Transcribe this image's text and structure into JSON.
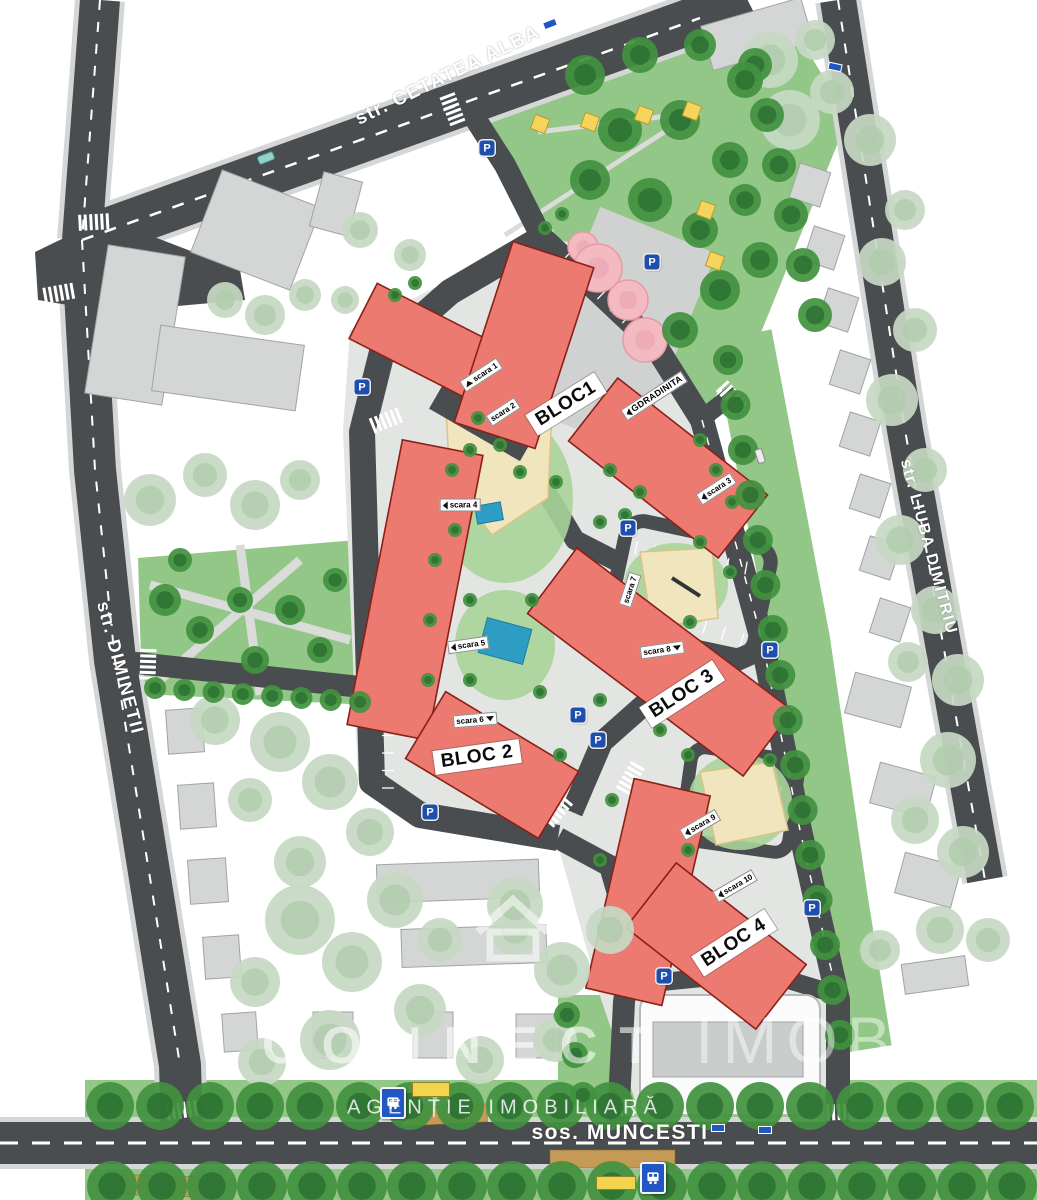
{
  "streets": {
    "top": "str. CETATEA ALBA",
    "left": "str. DIMINETII",
    "right": "str. LIUBA DIMITRIU",
    "bottom": "sos. MUNCESTI"
  },
  "buildings": {
    "bloc1": "BLOC1",
    "bloc2": "BLOC 2",
    "bloc3": "BLOC 3",
    "bloc4": "BLOC 4"
  },
  "entrances": [
    {
      "label": "scara 1"
    },
    {
      "label": "scara 2"
    },
    {
      "label": "scara 3"
    },
    {
      "label": "scara 4"
    },
    {
      "label": "scara 5"
    },
    {
      "label": "scara 6"
    },
    {
      "label": "scara 7"
    },
    {
      "label": "scara 8"
    },
    {
      "label": "scara 9"
    },
    {
      "label": "scara 10"
    }
  ],
  "facilities": {
    "kindergarten": "GDRADINITA",
    "parking": "P"
  },
  "watermark": {
    "brand_primary": "CONNECT",
    "brand_secondary": "IMOBIL",
    "tagline": "AGENȚIE IMOBILIARĂ"
  },
  "colors": {
    "building_red": "#ec7a70",
    "road": "#4a4d4f",
    "grass": "#93c787",
    "tree_dark": "#41913f",
    "tree_light": "#c6d9c3",
    "pool_blue": "#2e9dc4",
    "flower_pink": "#f3bac2",
    "sand": "#f1e5bd",
    "parking_blue": "#1f4fae",
    "shelter_yellow": "#f2d44f"
  }
}
